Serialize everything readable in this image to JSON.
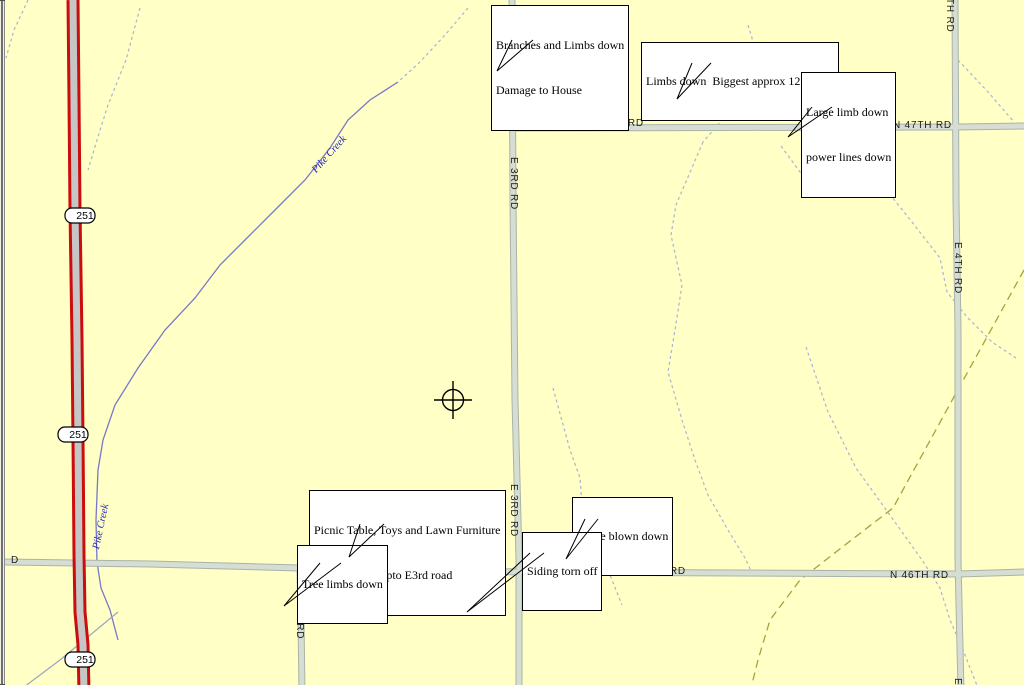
{
  "map": {
    "callouts": [
      {
        "lines": [
          "Branches and Limbs down",
          "Damage to House"
        ]
      },
      {
        "lines": [
          "Limbs down  Biggest approx 12 inches"
        ]
      },
      {
        "lines": [
          "Large limb down",
          "power lines down"
        ]
      },
      {
        "lines": [
          "Picnic Table, Toys and Lawn Furniture",
          "Blown to NE upto E3rd road"
        ]
      },
      {
        "lines": [
          "Tree limbs down"
        ]
      },
      {
        "lines": [
          "Fence blown down"
        ]
      },
      {
        "lines": [
          "Siding torn off"
        ]
      }
    ],
    "road_labels": {
      "n47_1": "N 47TH RD",
      "n47_2": "N 47TH RD",
      "e3_1": "E 3RD RD",
      "e3_2": "E 3RD RD",
      "e4_mid": "E 4TH RD",
      "e4_top_partial": "TH RD",
      "e4_bottom_partial": "E",
      "n46_1": "N 46TH RD",
      "n46_2": "N 46TH RD",
      "n46_3": "N 46TH RD",
      "e50": "E 50TH RD",
      "left_edge_partial": "D"
    },
    "highway_shields": [
      "251",
      "251",
      "251"
    ],
    "creek_labels": [
      "Pike Creek",
      "Pike Creek"
    ],
    "colors": {
      "background": "#FFFFC6",
      "road_fill": "#D6DDD3",
      "road_edge": "#A9B4A9",
      "highway_red": "#CC0D0D",
      "highway_gray": "#C6C6C6",
      "creek_blue": "#7878C8",
      "creek_label_blue": "#2222BB",
      "stream_dash_blue": "#A9B4D2",
      "boundary_olive": "#A3A33F",
      "callout_bg": "#FFFFFF",
      "callout_border": "#000000"
    }
  }
}
